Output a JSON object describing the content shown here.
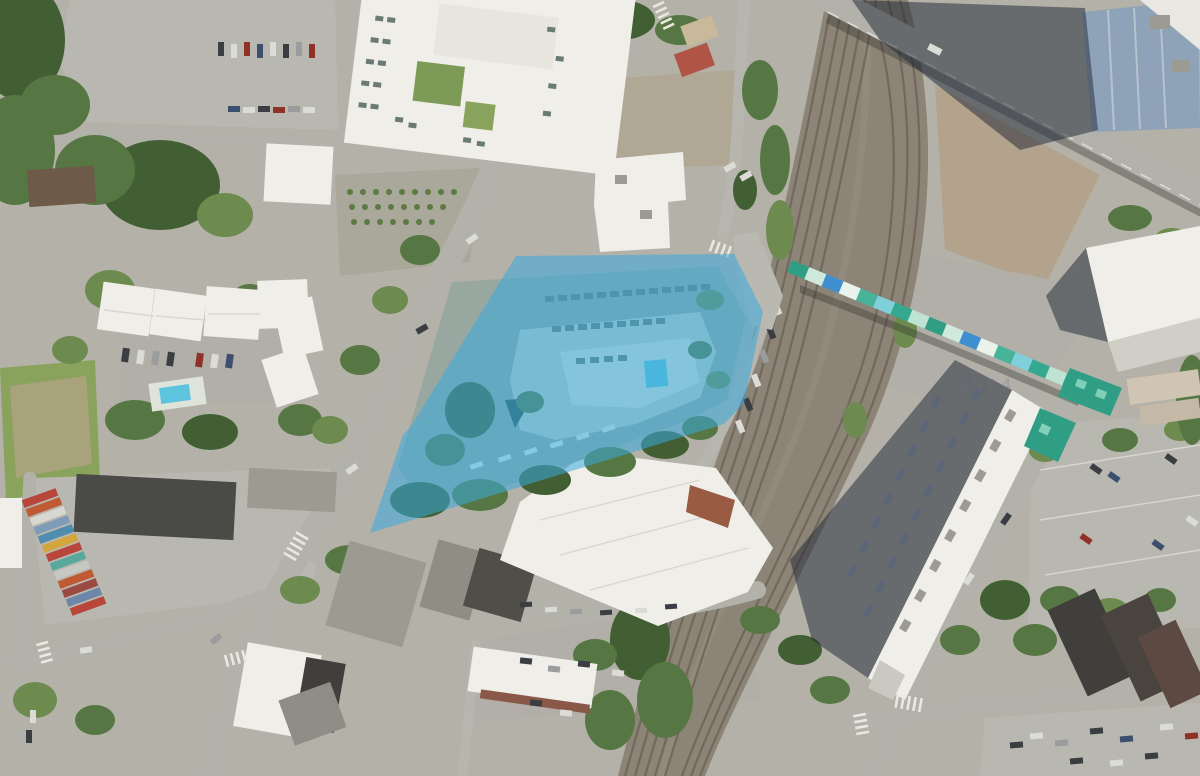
{
  "map": {
    "type": "aerial-satellite-photo",
    "subject": "Urban aerial view with highlighted development parcel beside a rail corridor and checkered pedestrian bridge",
    "watermark_text": "2024",
    "parcel_highlight": {
      "points": "516,256 734,254 763,312 744,403 724,424 370,533 403,435 412,425",
      "stroke_color": "#129fe6",
      "fill_color": "#37aadf",
      "fill_opacity": "0.32"
    },
    "pool_color": "#5ec4de",
    "canopy_color": "#2f9e85",
    "bridge_deck_colors": [
      "#2f9e85",
      "#cfeadd",
      "#3f8fd0",
      "#e9f3ec",
      "#47b49a",
      "#7fd0da",
      "#35a890",
      "#bfe3d2"
    ],
    "container_colors": [
      "#b8463a",
      "#c05a33",
      "#d8d8d2",
      "#7e9cb8",
      "#4f8cae",
      "#d2a63c",
      "#b8463a",
      "#58a89c",
      "#c8c8c2",
      "#c05a33",
      "#9a4a42",
      "#6e86a8",
      "#b8463a"
    ],
    "palette": {
      "ground": "#b4b2a8",
      "road": "#b2b1aa",
      "rail_bed": "#8c8477",
      "rail_track": "#6e6357",
      "tree_dark": "#415f33",
      "grass": "#8aa35c",
      "roof_white": "#efeee8",
      "roof_dark": "#403f3b",
      "shadow": "#232b38",
      "dirt": "#b3a28c"
    }
  }
}
